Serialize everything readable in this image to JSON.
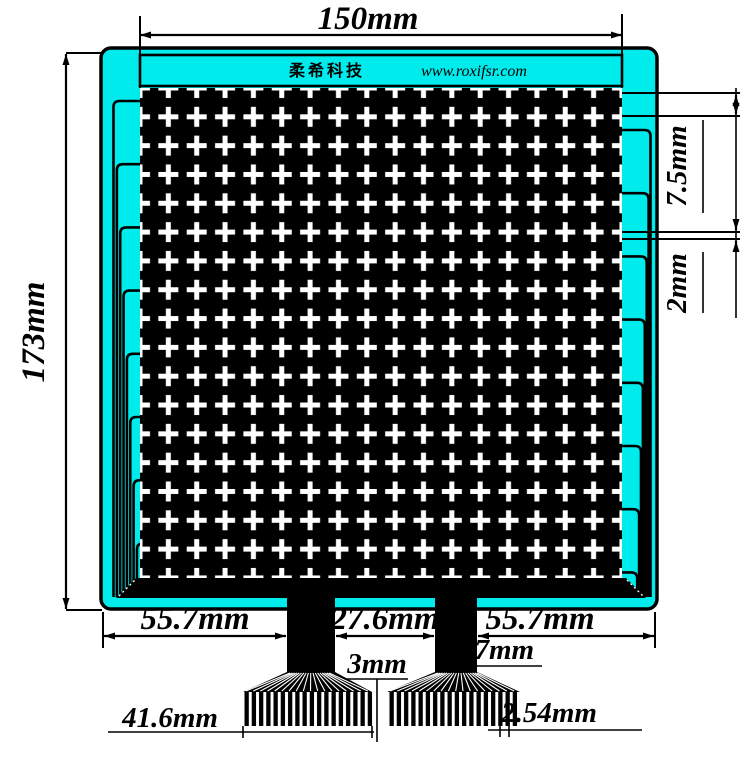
{
  "brand": {
    "name_cn": "柔希科技",
    "website": "www.roxifsr.com"
  },
  "dimensions": {
    "overall_width": "150mm",
    "overall_height": "173mm",
    "cell_pitch": "7.5mm",
    "cell_gap": "2mm",
    "bottom_left_margin": "55.7mm",
    "tail_spacing": "27.6mm",
    "bottom_right_margin": "55.7mm",
    "tail_trace_width": "3mm",
    "tail_width": "17mm",
    "fan_width": "41.6mm",
    "pin_pitch": "2.54mm"
  },
  "matrix": {
    "cross_rows": 17,
    "cross_cols": 17
  },
  "colors": {
    "substrate_cyan": "#00ECEC",
    "conductor_black": "#000000",
    "gap_white": "#FFFFFF"
  }
}
